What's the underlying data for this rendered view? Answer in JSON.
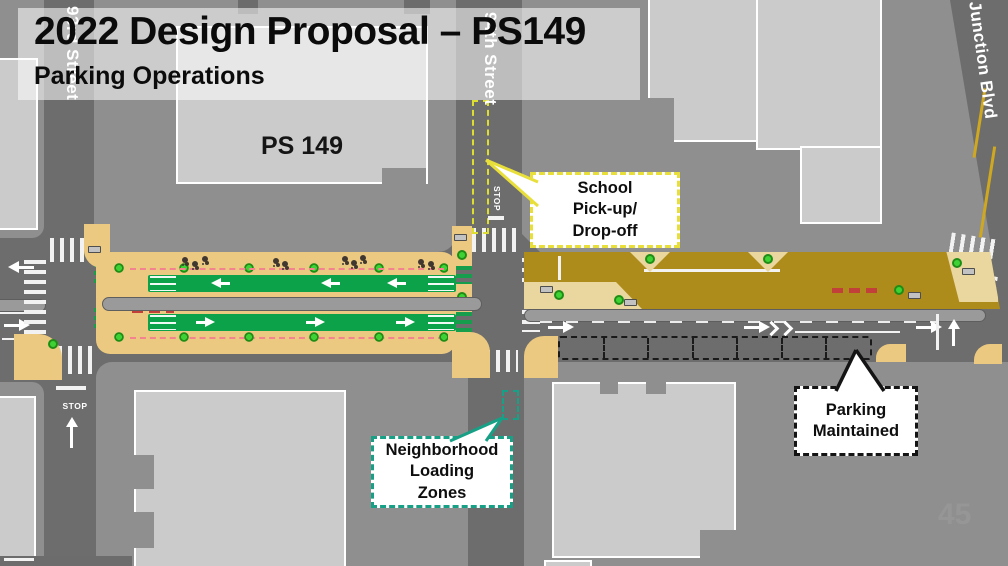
{
  "slide": {
    "title": "2022 Design Proposal – PS149",
    "subtitle": "Parking Operations",
    "page_number": "45"
  },
  "map": {
    "school_label": "PS 149",
    "stop_marking": "STOP",
    "streets": {
      "left": "93rd Street",
      "middle": "94th Street",
      "right": "Junction Blvd"
    },
    "callouts": {
      "school_pickup": {
        "lines": [
          "School",
          "Pick-up/",
          "Drop-off"
        ],
        "border_color": "#e9df3a"
      },
      "loading_zones": {
        "lines": [
          "Neighborhood",
          "Loading",
          "Zones"
        ],
        "border_color": "#17a085"
      },
      "parking_maintained": {
        "lines": [
          "Parking",
          "Maintained"
        ],
        "border_color": "#141414"
      }
    },
    "colors": {
      "plaza": "#ecc981",
      "bike_lane": "#0ca24a",
      "shared_street": "#ae8c1c",
      "planter": "#3fd235",
      "school_zone_dash": "#dede30",
      "loading_zone_dash": "#17a085",
      "parking_dash": "#1a1a1a",
      "street": "#6d6d6d",
      "sidewalk_block": "#8f8f8f",
      "building": "#cbcbcb"
    }
  }
}
